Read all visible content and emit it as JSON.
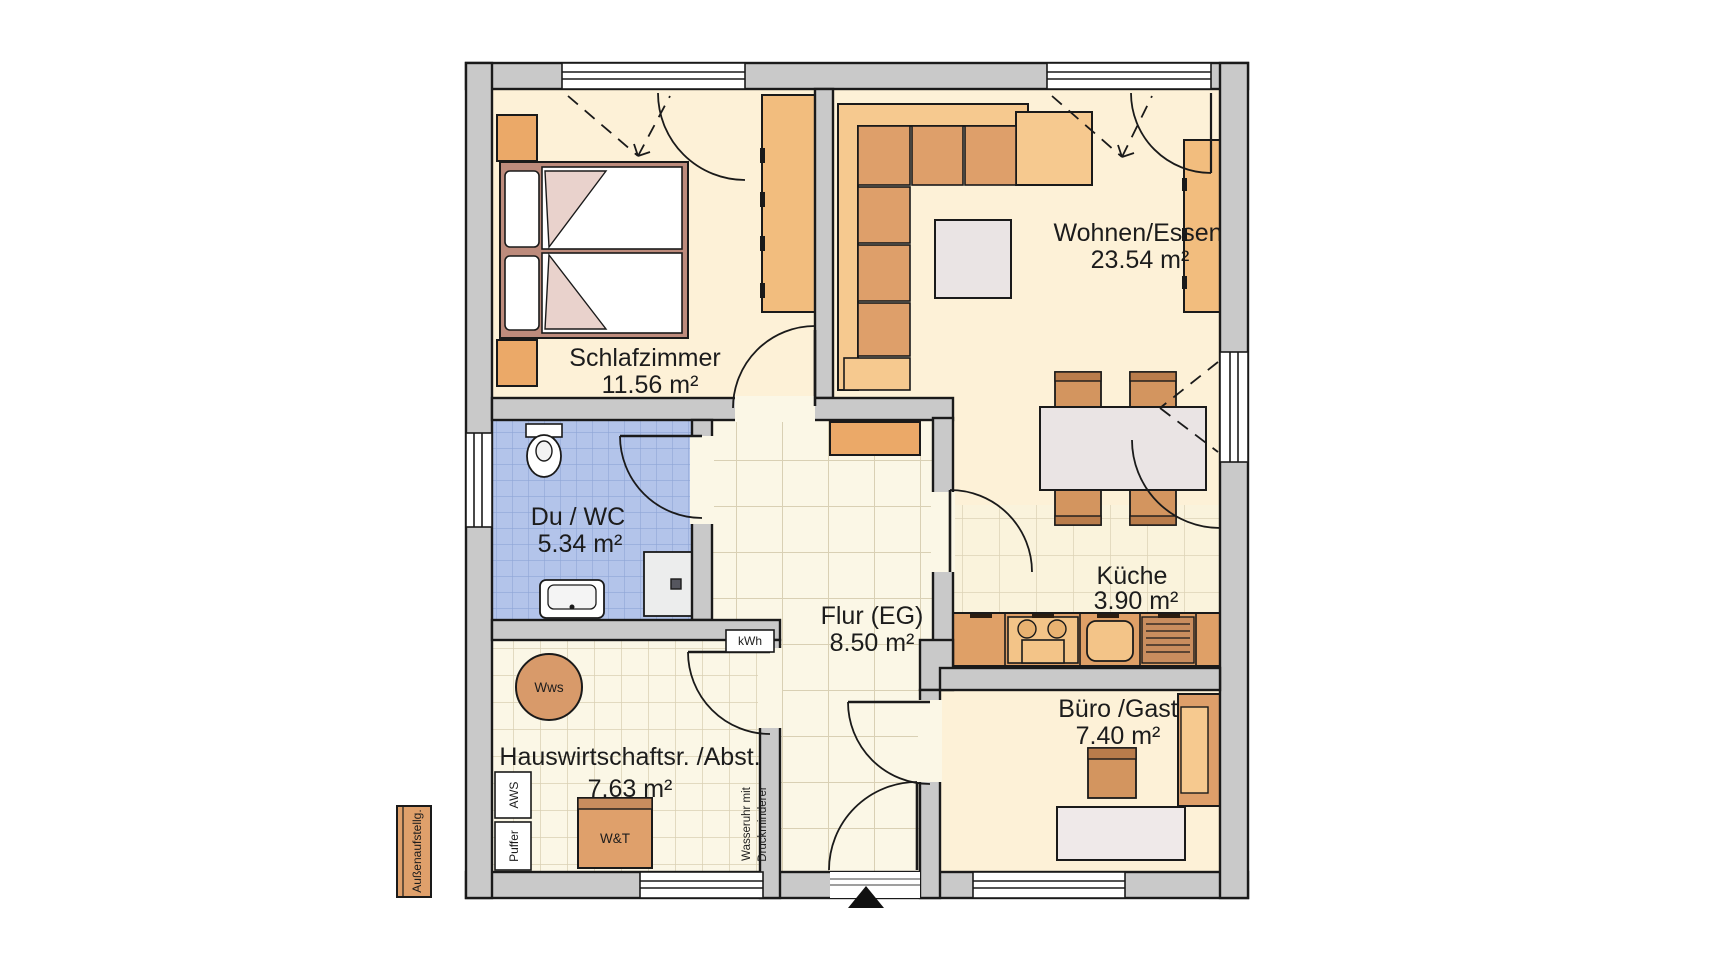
{
  "plan": {
    "title": "Erdgeschoss Grundriss",
    "rooms": [
      {
        "id": "schlafzimmer",
        "name": "Schlafzimmer",
        "area": "11.56 m²"
      },
      {
        "id": "wohnen-essen",
        "name": "Wohnen/Essen",
        "area": "23.54 m²"
      },
      {
        "id": "du-wc",
        "name": "Du / WC",
        "area": "5.34 m²"
      },
      {
        "id": "flur",
        "name": "Flur (EG)",
        "area": "8.50 m²"
      },
      {
        "id": "kueche",
        "name": "Küche",
        "area": "3.90 m²"
      },
      {
        "id": "hwr",
        "name": "Hauswirtschaftsr. /Abst.",
        "area": "7.63 m²"
      },
      {
        "id": "buero",
        "name": "Büro /Gast",
        "area": "7.40 m²"
      }
    ],
    "equipment": {
      "kwh": "kWh",
      "wws": "Wws",
      "aws": "AWS",
      "puffer": "Puffer",
      "wt": "W&T",
      "wasseruhr_line1": "Wasseruhr mit",
      "wasseruhr_line2": "Druckminderer",
      "aussenaufstellung": "Außenaufstellg."
    },
    "colors": {
      "wall": "#c9c9c9",
      "outline": "#1a1a1a",
      "floor_cream": "#fdf1d7",
      "tile_bg": "#fbf7e6",
      "tile_line": "#d9d0b4",
      "bath_tile": "#b3c4ea",
      "bath_line": "#8fa6d6",
      "furniture_orange": "#de9f6a",
      "furniture_light": "#f6c98f",
      "cabinet_orange": "#f2bd7e",
      "wood_brown": "#d3955f",
      "bed_frame": "#bd8b7c",
      "table_gray": "#eae4e4"
    }
  }
}
